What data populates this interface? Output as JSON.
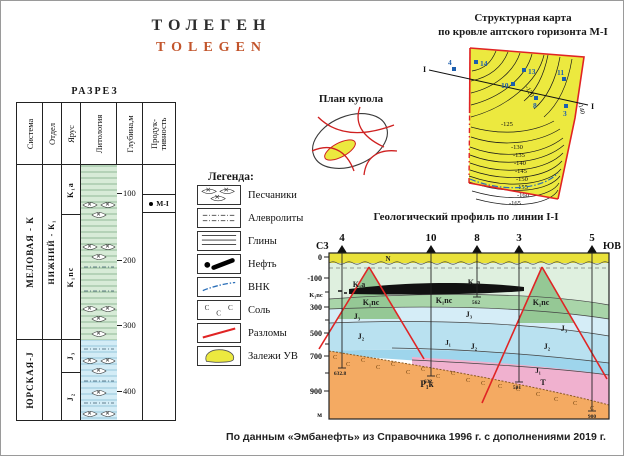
{
  "title": {
    "ru": "ТОЛЕГЕН",
    "en": "TOLEGEN"
  },
  "razrez": {
    "title": "РАЗРЕЗ",
    "headers": {
      "system": "Система",
      "otdel": "Отдел",
      "yarus": "Ярус",
      "lithology": "Литология",
      "depth": "Глубина,м",
      "productivity": "Продук- тивность"
    },
    "system_rows": [
      "МЕЛОВАЯ - К",
      "ЮРСКАЯ-J"
    ],
    "otdel_rows": [
      "НИЖНИЙ - К₁"
    ],
    "yarus_rows": [
      "K₁a",
      "K₁nc",
      "J₃",
      "J₂"
    ],
    "depth_marks": [
      "100",
      "200",
      "300",
      "400"
    ],
    "productivity_marker": "М-I"
  },
  "dome": {
    "title": "План купола"
  },
  "legend": {
    "title": "Легенда:",
    "items": [
      "Песчаники",
      "Алевролиты",
      "Глины",
      "Нефть",
      "ВНК",
      "Соль",
      "Разломы",
      "Залежи УВ"
    ],
    "salt_letter": "C"
  },
  "map": {
    "title1": "Структурная карта",
    "title2": "по кровле аптского горизонта М-I",
    "line_label": "I",
    "wells": [
      "4",
      "14",
      "13",
      "10",
      "11",
      "8",
      "3"
    ],
    "contours": [
      "-120",
      "-125",
      "-130",
      "-135",
      "-140",
      "-145",
      "-150",
      "-155",
      "-160",
      "-165"
    ]
  },
  "profile": {
    "title": "Геологический профиль по линии I-I",
    "nw": "СЗ",
    "se": "ЮВ",
    "wells": [
      {
        "n": "4",
        "d": "632.8"
      },
      {
        "n": "10",
        "d": "632"
      },
      {
        "n": "8",
        "d": "562"
      },
      {
        "n": "3",
        "d": "581"
      },
      {
        "n": "5",
        "d": "900"
      }
    ],
    "scale": [
      "0",
      "-100",
      "300",
      "500",
      "700",
      "900"
    ],
    "unit": "м",
    "labels": {
      "n": "N",
      "k1a": "K₁a",
      "k1nc": "K₁nc",
      "j3": "J₃",
      "j2": "J₂",
      "j1": "J₁",
      "t": "T",
      "p1k": "P₁k"
    },
    "salt_letter": "C"
  },
  "caption": "По данным «Эмбанефть» из Справочника 1996 г. с дополнениями 2019 г.",
  "colors": {
    "accent_orange": "#c2552c",
    "map_yellow": "#ece93f",
    "fault_red": "#e02424",
    "vnk_blue": "#2b6fb8",
    "k1a_green": "#dff0df",
    "k1nc_green": "#a9d5a9",
    "jurassic_blue": "#b9e1f0",
    "triassic_pink": "#f0b1cf",
    "perm_orange": "#f4aa62",
    "oil_black": "#111111"
  }
}
